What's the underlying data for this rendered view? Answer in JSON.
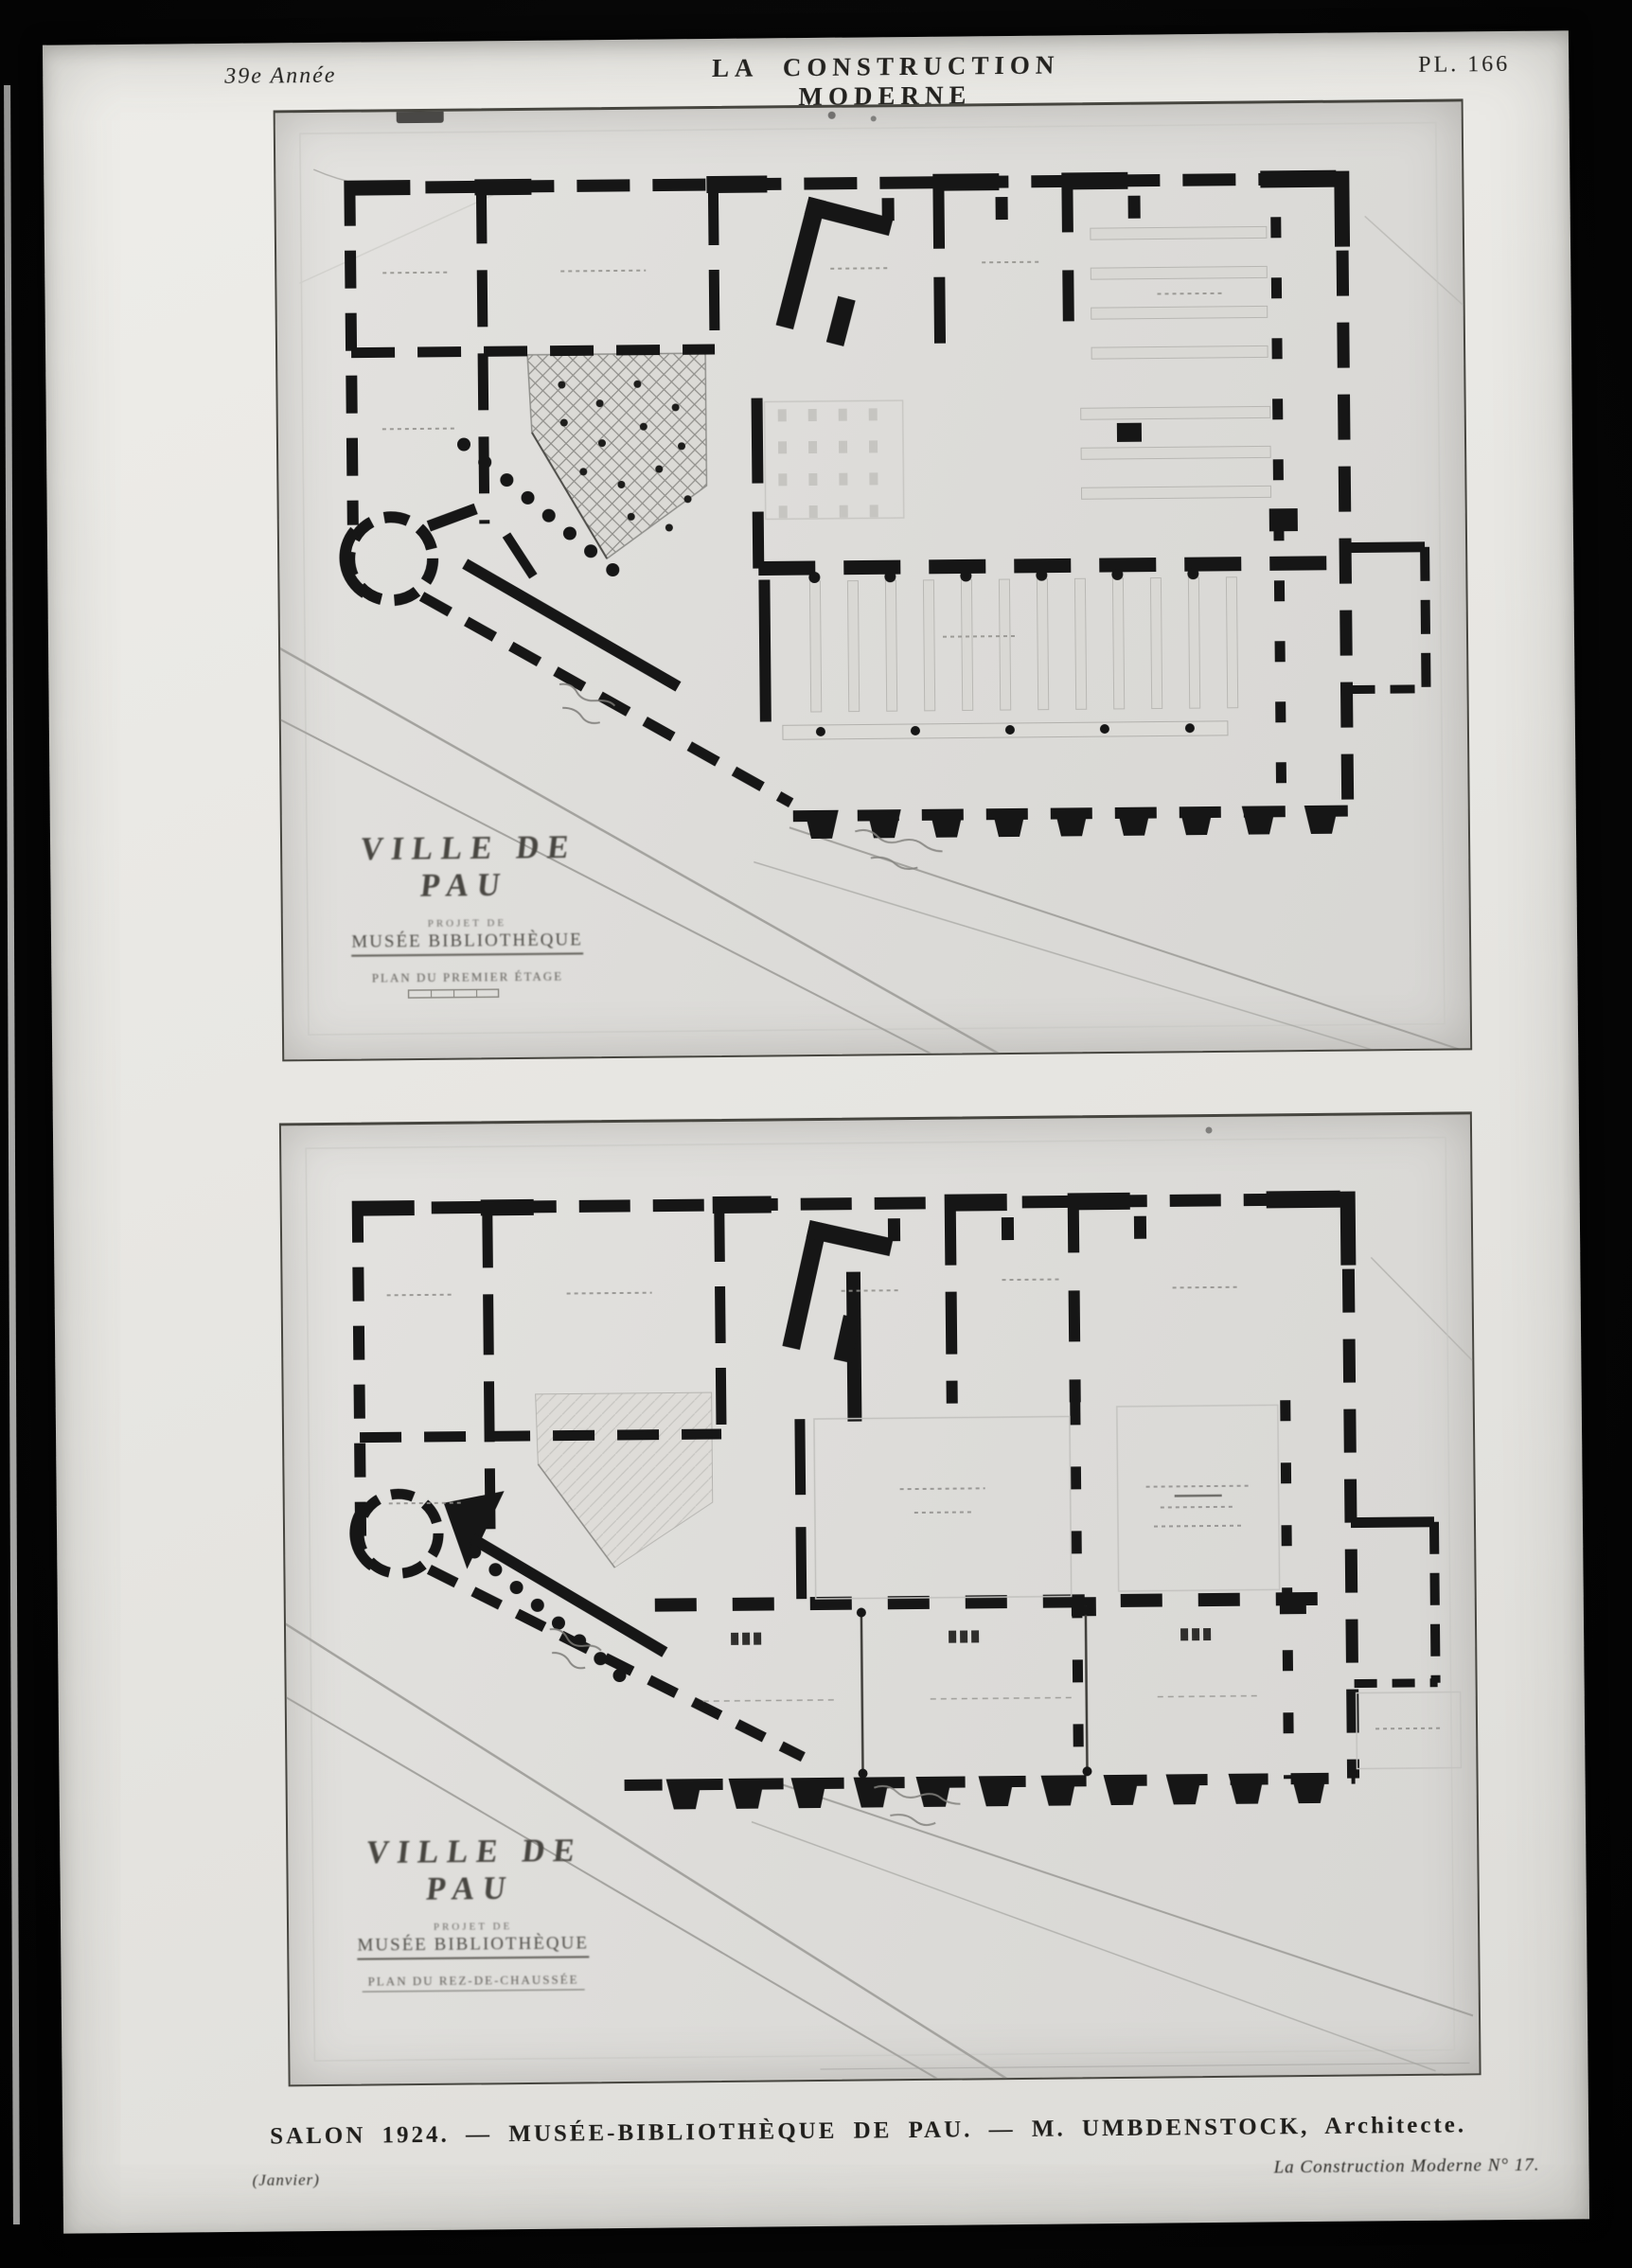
{
  "document": {
    "kind": "scanned journal plate",
    "colors": {
      "background": "#050505",
      "paper": "#e9e8e4",
      "photo_panel": "#deddda",
      "ink": "#161616",
      "faint_ink": "#8f8e8a"
    }
  },
  "header": {
    "year": "39e Année",
    "journal_title": "LA CONSTRUCTION MODERNE",
    "plate_number": "PL. 166"
  },
  "plans": [
    {
      "name": "upper-floor-plan",
      "title_block": {
        "city": "VILLE DE PAU",
        "subtitle": "PROJET DE",
        "building": "MUSÉE BIBLIOTHÈQUE",
        "level": "PLAN DU PREMIER ÉTAGE"
      }
    },
    {
      "name": "ground-floor-plan",
      "title_block": {
        "city": "VILLE DE PAU",
        "subtitle": "PROJET DE",
        "building": "MUSÉE BIBLIOTHÈQUE",
        "level": "PLAN DU REZ-DE-CHAUSSÉE"
      }
    }
  ],
  "caption": {
    "main": "SALON 1924. — MUSÉE-BIBLIOTHÈQUE DE PAU. — M. UMBDENSTOCK, Architecte.",
    "month": "(Janvier)",
    "issue": "La Construction Moderne N° 17."
  }
}
